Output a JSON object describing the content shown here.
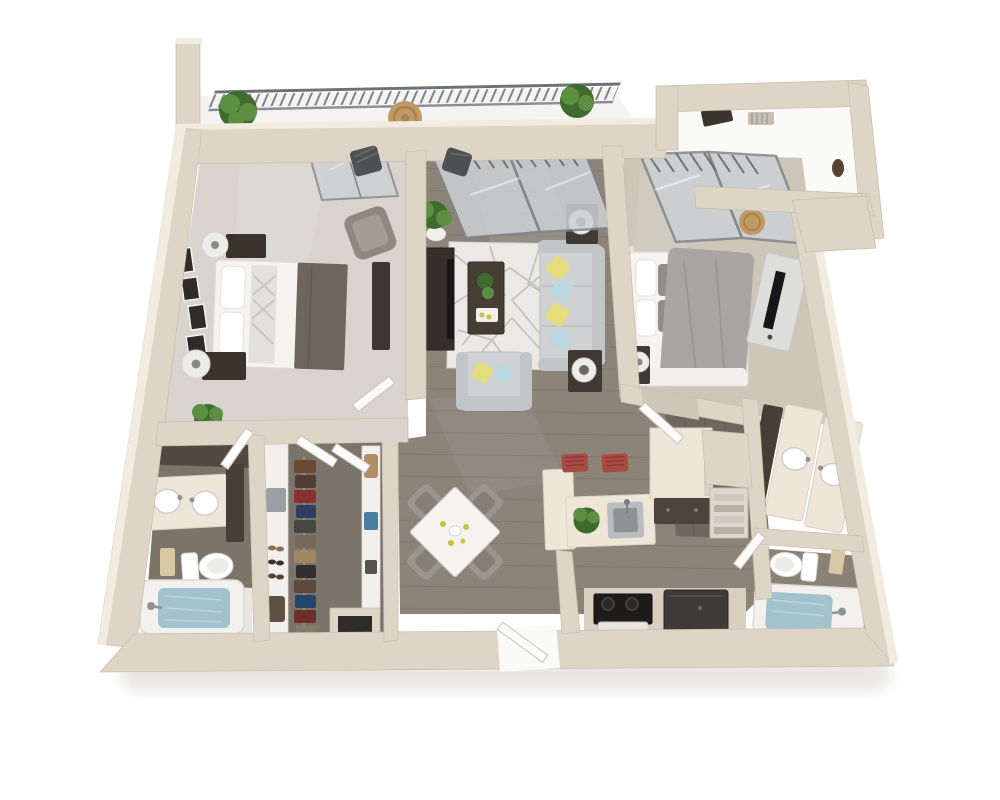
{
  "meta": {
    "description": "3D top-down rendered floor plan of a two-bedroom, two-bathroom apartment with balcony, living room, dining area, kitchen and walk-in closet",
    "render_style": "3d-dollhouse-top-view",
    "background": "#ffffff",
    "visible_text": ""
  },
  "palette": {
    "wall": "#ded5c6",
    "wallTop": "#f1ebe0",
    "wallEdge": "#c7bcab",
    "carpetL": "#d8d4cd",
    "carpetR": "#cdc7ba",
    "wood": "#8c8379",
    "woodDark": "#6f675e",
    "woodLight": "#a59d92",
    "balconyFloor": "#f4f3f1",
    "alcoveFloor": "#fafaf8",
    "glass": "#ccd0d3",
    "glassFrame": "#80868b",
    "railing": "#6d7277",
    "rug": "#eae9e5",
    "rugLine": "#bdbbb5",
    "sofa": "#cfd1d3",
    "sofaShade": "#b9bcbf",
    "pillowY": "#e3dd7d",
    "pillowB": "#bad8e1",
    "furnDark": "#3b342c",
    "tableDark": "#4a4138",
    "tv": "#17171a",
    "linen": "#f4f3f0",
    "blanket": "#6e655c",
    "duvet": "#a8a5a2",
    "plant": "#5d8f43",
    "plantDark": "#3f6b2e",
    "potWhite": "#f0efec",
    "counter": "#eee7d9",
    "counterFace": "#d9d0bf",
    "cabinetDark": "#4d453b",
    "stool": "#a94a42",
    "steel": "#b9bdbf",
    "steelDark": "#8e9294",
    "water": "#a2c2cc",
    "towel": "#d8c8a4",
    "closetFloor": "#7b746a",
    "shelfWhite": "#f2f0ec",
    "doorWhite": "#fbfbfa",
    "chairGray": "#9b958d",
    "lampWhite": "#ececea",
    "wicker": "#bf9a64"
  },
  "closet_colors": [
    "#6b4a33",
    "#503f31",
    "#8a3030",
    "#2e3e63",
    "#474644",
    "#76695a",
    "#a08763",
    "#33312e",
    "#5d4a3a",
    "#24486b",
    "#6e2f2a",
    "#857a68"
  ],
  "rooms": [
    {
      "id": "balcony",
      "label": "balcony",
      "items": [
        "metal-railing",
        "potted-plant",
        "potted-plant",
        "round-wicker-table",
        "patio-chair",
        "patio-chair"
      ]
    },
    {
      "id": "bedroom-1",
      "label": "bedroom-left",
      "items": [
        "queen-bed",
        "white-linens",
        "accent-blanket",
        "nightstand",
        "nightstand",
        "table-lamp",
        "table-lamp",
        "gallery-wall-frames",
        "accent-chair",
        "dresser",
        "floor-plant",
        "window"
      ]
    },
    {
      "id": "living-room",
      "label": "living-room",
      "items": [
        "sliding-glass-door",
        "sofa",
        "throw-pillows",
        "accent-armchair",
        "coffee-table",
        "geometric-area-rug",
        "media-console",
        "flat-screen-tv",
        "side-table",
        "side-table",
        "drum-lamp",
        "drum-lamp",
        "potted-plant"
      ]
    },
    {
      "id": "dining-area",
      "label": "dining-area",
      "items": [
        "square-table",
        "dining-chair",
        "dining-chair",
        "dining-chair",
        "dining-chair",
        "centerpiece"
      ]
    },
    {
      "id": "kitchen",
      "label": "kitchen",
      "items": [
        "l-shaped-counter",
        "stainless-steel-sink",
        "faucet",
        "herb-plant",
        "bar-stool",
        "bar-stool",
        "tall-cabinets",
        "base-cabinet",
        "range-oven",
        "refrigerator"
      ]
    },
    {
      "id": "bedroom-2",
      "label": "bedroom-right",
      "items": [
        "queen-bed",
        "gray-duvet",
        "headboard-shelf",
        "nightstand",
        "table-lamp",
        "media-console",
        "flat-screen-tv",
        "sliding-glass-door"
      ]
    },
    {
      "id": "bathroom-1",
      "label": "bathroom-left",
      "items": [
        "double-vanity",
        "sink",
        "sink",
        "linen-cabinet",
        "toilet",
        "towel-stack",
        "bathtub"
      ]
    },
    {
      "id": "bathroom-2",
      "label": "bathroom-right",
      "items": [
        "double-vanity",
        "sink",
        "sink",
        "linen-cabinet",
        "toilet",
        "towel-stack",
        "bathtub"
      ]
    },
    {
      "id": "walk-in-closet",
      "label": "walk-in-closet",
      "items": [
        "hanging-clothes",
        "shelving-unit",
        "shoe-rack",
        "storage-box",
        "handbag"
      ]
    },
    {
      "id": "entry",
      "label": "entry",
      "items": [
        "entry-door"
      ]
    },
    {
      "id": "foyer-alcove",
      "label": "entry-alcove",
      "items": [
        "console-tray",
        "wall-unit",
        "decor-vase"
      ]
    },
    {
      "id": "linen-niche",
      "label": "linen-closet",
      "items": [
        "towel-shelves"
      ]
    }
  ]
}
